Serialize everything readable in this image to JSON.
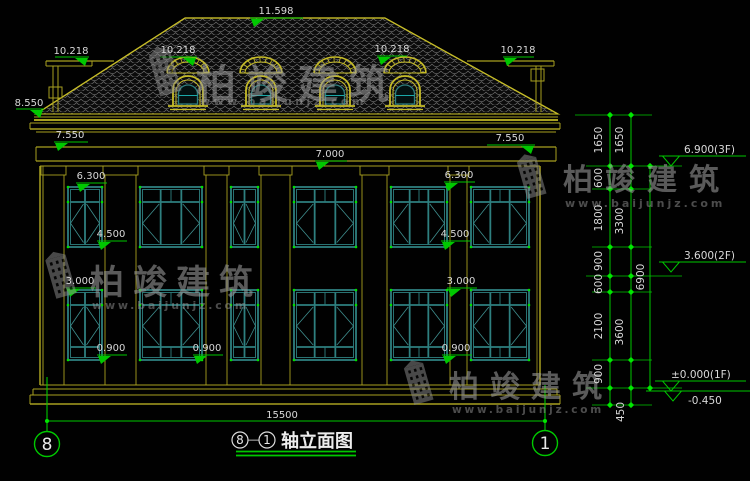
{
  "watermark": {
    "brand": "柏竣建筑",
    "url": "www.baijunjz.com"
  },
  "roof_dims": {
    "ridge": "11.598",
    "main_eave": "8.550",
    "side_eave_left": "10.218",
    "dormer_left": "10.218",
    "dormer_right": "10.218",
    "side_eave_right": "10.218"
  },
  "wall_dims": {
    "parapet_left": "7.550",
    "parapet_right": "7.550",
    "frieze_center": "7.000",
    "lintel_2f_left": "6.300",
    "lintel_2f_right": "6.300",
    "sill_2f_left": "4.500",
    "sill_2f_right": "4.500",
    "lintel_1f_left": "3.000",
    "lintel_1f_right": "3.000",
    "sill_1f_left": "0.900",
    "sill_1f_mid": "0.900",
    "sill_1f_right": "0.900",
    "total_width": "15500"
  },
  "dim_chains": {
    "inner": [
      "1650",
      "600",
      "1800",
      "900",
      "600",
      "2100",
      "900"
    ],
    "middle": [
      "1650",
      "3300",
      "3600",
      "450"
    ],
    "outer": [
      "6900"
    ]
  },
  "levels": {
    "f3": "6.900(3F)",
    "f2": "3.600(2F)",
    "f1": "±0.000(1F)",
    "ground": "-0.450"
  },
  "axes": {
    "left": "8",
    "right": "1"
  },
  "title": {
    "axis_from": "8",
    "separator": "—",
    "axis_to": "1",
    "name": "轴立面图"
  },
  "colors": {
    "cad_yellow": "#a8a020",
    "bright_yellow": "#c6bc28",
    "window_teal": "#2e7f7f",
    "dim_green": "#00c800",
    "text_gray": "#d9d9d9",
    "watermark_gray": "#9a9a9a"
  }
}
